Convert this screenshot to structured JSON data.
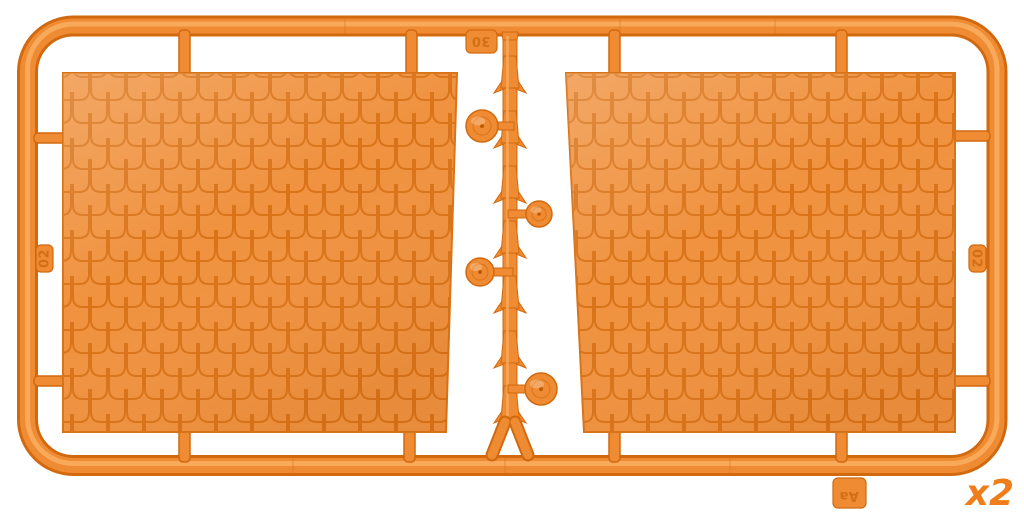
{
  "image": {
    "description": "Orange plastic model-kit sprue with two roof tile panels, serrated ridge strip and four dome finials",
    "quantity_label": "x2"
  },
  "colors": {
    "plastic_dark": "#d2690e",
    "plastic_mid": "#ef8c33",
    "plastic_light": "#f9ac5e",
    "tile_fill": "#f0923f",
    "tile_line": "#d97318",
    "emboss": "#c9650a",
    "label_orange": "#ee7d1a",
    "bg": "#ffffff"
  },
  "sprue": {
    "tabs": {
      "top_label": "30",
      "left_label": "02",
      "right_label": "02",
      "bottom_label": "Aa"
    },
    "parts": {
      "panel_count": "2",
      "knob_count": "4"
    }
  }
}
